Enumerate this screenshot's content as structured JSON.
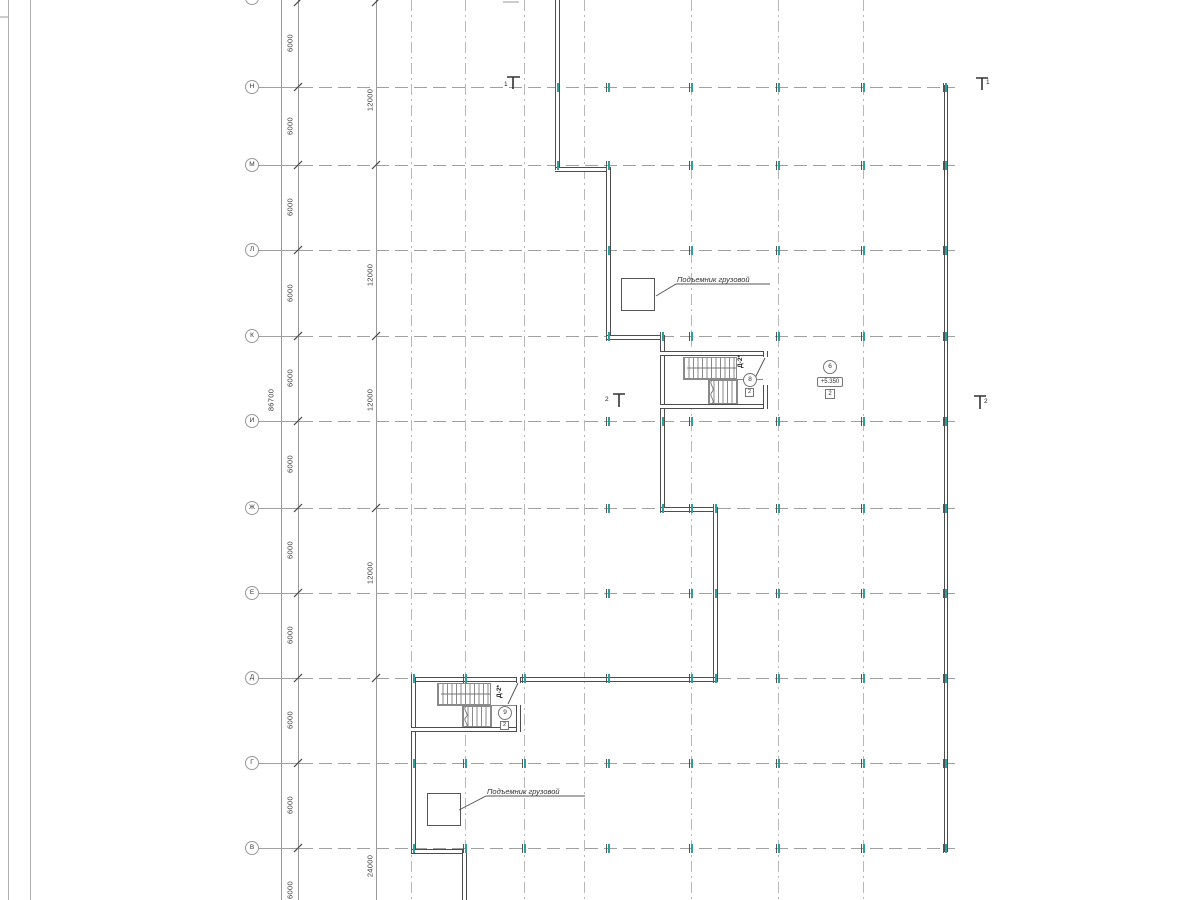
{
  "rows": {
    "labels": [
      "Н",
      "М",
      "Л",
      "К",
      "И",
      "Ж",
      "Е",
      "Д",
      "Г",
      "В"
    ]
  },
  "dims": {
    "overall": "86700",
    "small": [
      "6000",
      "6000",
      "6000",
      "6000",
      "6000",
      "6000",
      "6000",
      "6000",
      "6000",
      "6000",
      "6000"
    ],
    "major": [
      "12000",
      "12000",
      "12000",
      "12000",
      "24000"
    ]
  },
  "labels": {
    "hoist_upper": "Подъемник грузовой",
    "hoist_lower": "Подъемник грузовой"
  },
  "tags": {
    "upper_stair": {
      "door": "Д-2*",
      "num": "8",
      "sub": "2"
    },
    "lower_stair": {
      "door": "Д-2*",
      "num": "9",
      "sub": "2"
    },
    "level": {
      "num": "6",
      "elevation": "+5.350",
      "sub": "2"
    }
  },
  "sections": {
    "one": "1",
    "two": "2"
  },
  "colors": {
    "wall": "#4d4d4d",
    "grid": "#a6a6a6",
    "column_tick": "#2f9e9e"
  }
}
